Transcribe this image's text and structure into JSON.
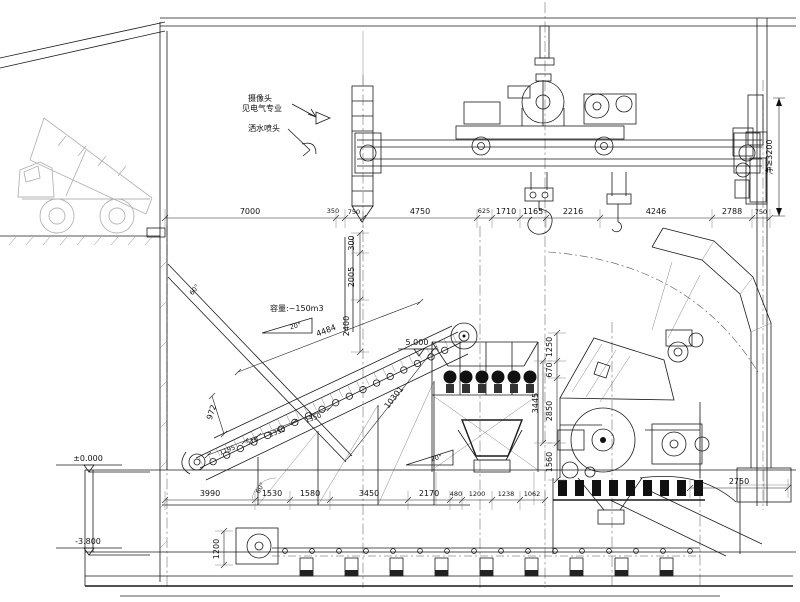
{
  "labels": {
    "camera_line1": "摄像头",
    "camera_line2": "见电气专业",
    "sprinkler": "洒水喷头",
    "capacity": "容量:~150m3",
    "clearance": "净≥3200",
    "elev_feeder_head": "5.000",
    "elev_ground": "±0.000",
    "elev_pit": "-3.800",
    "angle_feed_upper": "20°",
    "angle_feed_lower": "20°",
    "angle_slope_upper": "60°",
    "angle_slope_lower": "60°"
  },
  "dims": {
    "top": [
      "7000",
      "350",
      "750",
      "4750",
      "625",
      "1710",
      "1165",
      "2216",
      "4246",
      "2788",
      "750"
    ],
    "bottom": [
      "3990",
      "1530",
      "1580",
      "3450",
      "2170",
      "480",
      "1200",
      "1238",
      "1062"
    ],
    "right_vertical": [
      "1250",
      "670",
      "2850",
      "1560"
    ],
    "right_vertical_overall": "3445",
    "chute_vertical": [
      "300",
      "2005",
      "2400"
    ],
    "incline_top": "4484",
    "incline_bottom": [
      "1195",
      "510",
      "1350",
      "1350"
    ],
    "tail_height": "972",
    "hopper_slope": "10301",
    "crusher_right": "2750",
    "belt_tail_height": "1200"
  }
}
